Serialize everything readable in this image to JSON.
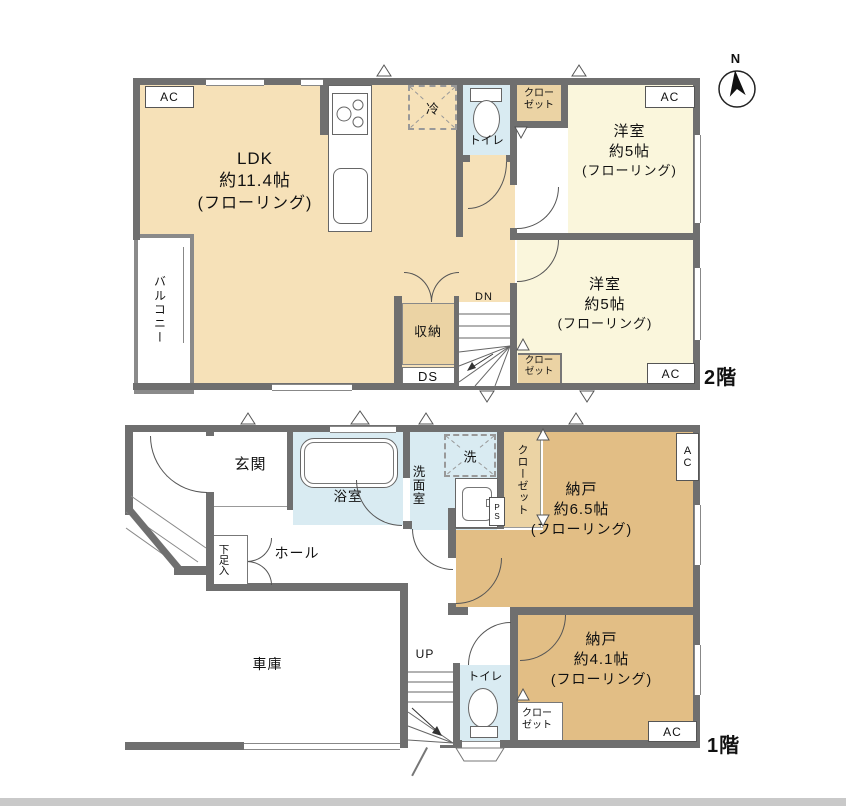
{
  "colors": {
    "wall": "#6F6F6F",
    "cream": "#F6E1B8",
    "yellow": "#FAF6DC",
    "blue": "#D9EBF2",
    "tan": "#E2BE85",
    "tan_light": "#EBD3A4"
  },
  "labels": {
    "ac": "AC",
    "dn": "DN",
    "up": "UP",
    "ds": "DS",
    "ps": "PS",
    "north": "N",
    "floor2": "2階",
    "floor1": "1階",
    "fridge": "冷",
    "washer": "洗",
    "closet_l1": "クロー",
    "closet_l2": "ゼット",
    "closet_v": "クローゼット"
  },
  "floor2": {
    "ldk": {
      "name": "LDK",
      "size": "約11.4帖",
      "finish": "(フローリング)"
    },
    "balcony": "バルコニー",
    "toilet": "トイレ",
    "storage": "収納",
    "bedroom1": {
      "name": "洋室",
      "size": "約5帖",
      "finish": "(フローリング)"
    },
    "bedroom2": {
      "name": "洋室",
      "size": "約5帖",
      "finish": "(フローリング)"
    }
  },
  "floor1": {
    "entrance": "玄関",
    "bathroom": "浴室",
    "washroom": "洗面室",
    "shoe_cabinet": "下足入",
    "hall": "ホール",
    "garage": "車庫",
    "toilet": "トイレ",
    "storage1": {
      "name": "納戸",
      "size": "約6.5帖",
      "finish": "(フローリング)"
    },
    "storage2": {
      "name": "納戸",
      "size": "約4.1帖",
      "finish": "(フローリング)"
    }
  }
}
